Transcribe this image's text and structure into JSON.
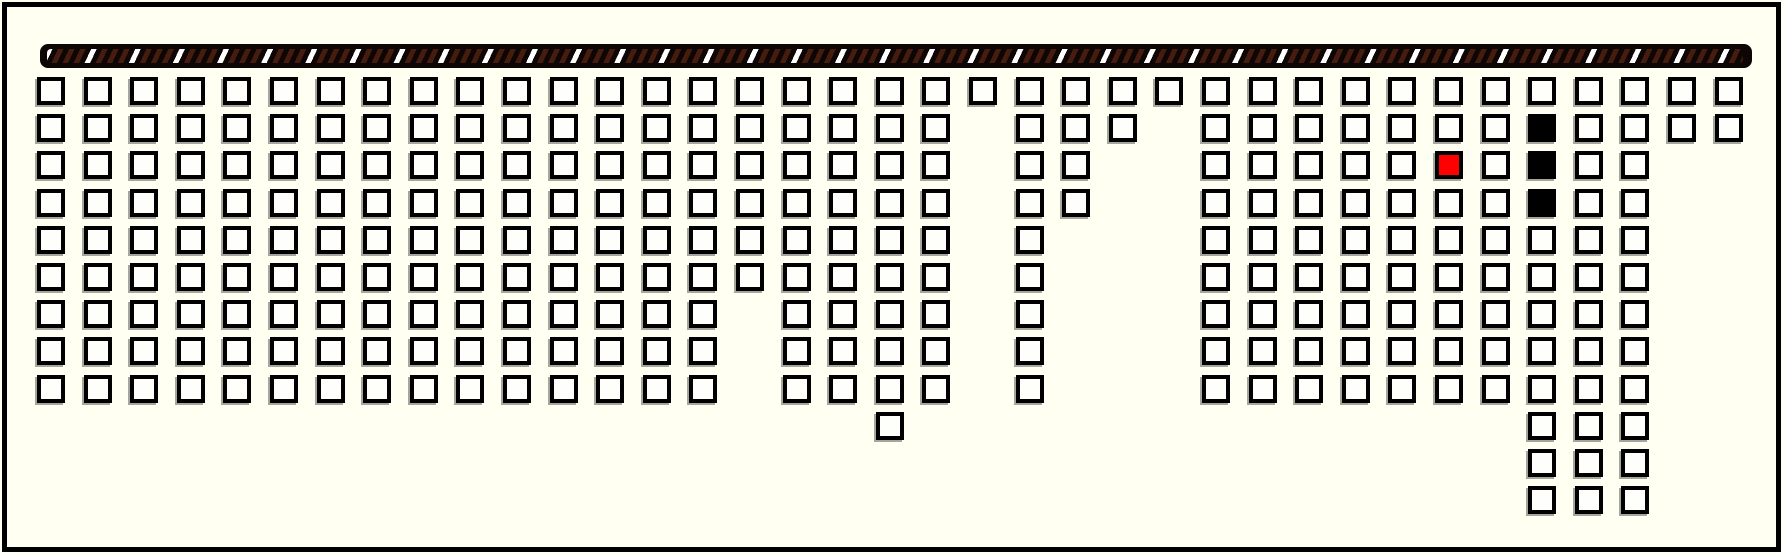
{
  "app": {
    "name": "seat-map",
    "description": "seating chart with hatched screen bar, white available seats, one red selected seat, three black occupied seats"
  },
  "colors": {
    "background": "#fffff2",
    "frame_border": "#000000",
    "seat_fill_available": "#fefefa",
    "seat_border": "#000000",
    "seat_fill_selected": "#ff0000",
    "seat_fill_occupied": "#000000",
    "screen_bar_base": "#0d0604",
    "screen_stripe_brown": "#451c0e",
    "screen_stripe_white": "#ffffff"
  },
  "screen_bar": {
    "style": "diagonal-hatched"
  },
  "seat_grid": {
    "total_columns": 37,
    "total_rows": 12,
    "total_seats": 298,
    "columns": [
      {
        "col": 0,
        "row_start": 0,
        "row_end": 8
      },
      {
        "col": 1,
        "row_start": 0,
        "row_end": 8
      },
      {
        "col": 2,
        "row_start": 0,
        "row_end": 8
      },
      {
        "col": 3,
        "row_start": 0,
        "row_end": 8
      },
      {
        "col": 4,
        "row_start": 0,
        "row_end": 8
      },
      {
        "col": 5,
        "row_start": 0,
        "row_end": 8
      },
      {
        "col": 6,
        "row_start": 0,
        "row_end": 8
      },
      {
        "col": 7,
        "row_start": 0,
        "row_end": 8
      },
      {
        "col": 8,
        "row_start": 0,
        "row_end": 8
      },
      {
        "col": 9,
        "row_start": 0,
        "row_end": 8
      },
      {
        "col": 10,
        "row_start": 0,
        "row_end": 8
      },
      {
        "col": 11,
        "row_start": 0,
        "row_end": 8
      },
      {
        "col": 12,
        "row_start": 0,
        "row_end": 8
      },
      {
        "col": 13,
        "row_start": 0,
        "row_end": 8
      },
      {
        "col": 14,
        "row_start": 0,
        "row_end": 8
      },
      {
        "col": 15,
        "row_start": 0,
        "row_end": 5
      },
      {
        "col": 16,
        "row_start": 0,
        "row_end": 8
      },
      {
        "col": 17,
        "row_start": 0,
        "row_end": 8
      },
      {
        "col": 18,
        "row_start": 0,
        "row_end": 9
      },
      {
        "col": 19,
        "row_start": 0,
        "row_end": 8
      },
      {
        "col": 20,
        "row_start": 0,
        "row_end": 0
      },
      {
        "col": 21,
        "row_start": 0,
        "row_end": 8
      },
      {
        "col": 22,
        "row_start": 0,
        "row_end": 3
      },
      {
        "col": 23,
        "row_start": 0,
        "row_end": 1
      },
      {
        "col": 24,
        "row_start": 0,
        "row_end": 0
      },
      {
        "col": 25,
        "row_start": 0,
        "row_end": 8
      },
      {
        "col": 26,
        "row_start": 0,
        "row_end": 8
      },
      {
        "col": 27,
        "row_start": 0,
        "row_end": 8
      },
      {
        "col": 28,
        "row_start": 0,
        "row_end": 8
      },
      {
        "col": 29,
        "row_start": 0,
        "row_end": 8
      },
      {
        "col": 30,
        "row_start": 0,
        "row_end": 8
      },
      {
        "col": 31,
        "row_start": 0,
        "row_end": 8
      },
      {
        "col": 32,
        "row_start": 0,
        "row_end": 11
      },
      {
        "col": 33,
        "row_start": 0,
        "row_end": 11
      },
      {
        "col": 34,
        "row_start": 0,
        "row_end": 11
      },
      {
        "col": 35,
        "row_start": 0,
        "row_end": 1
      },
      {
        "col": 36,
        "row_start": 0,
        "row_end": 1
      }
    ],
    "special_seats": [
      {
        "col": 30,
        "row": 2,
        "state": "selected"
      },
      {
        "col": 32,
        "row": 1,
        "state": "occupied"
      },
      {
        "col": 32,
        "row": 2,
        "state": "occupied"
      },
      {
        "col": 32,
        "row": 3,
        "state": "occupied"
      }
    ]
  }
}
